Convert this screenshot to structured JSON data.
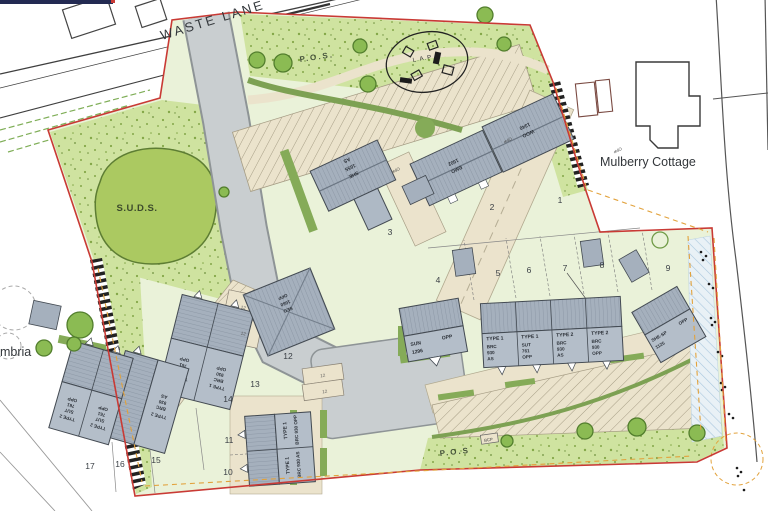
{
  "labels": {
    "waste_lane": "WASTE LANE",
    "mulberry_cottage": "Mulberry Cottage",
    "suds": "S.U.D.S.",
    "pos_top": "P.O.S.",
    "pos_bottom": "P.O.S",
    "lap": "L.A.P",
    "cumbria_partial": "mbria",
    "bcp": "BCP"
  },
  "plot_numbers": [
    "1",
    "2",
    "3",
    "4",
    "5",
    "6",
    "7",
    "8",
    "9",
    "10",
    "11",
    "12",
    "13",
    "14",
    "15",
    "16",
    "17"
  ],
  "bay_labels": [
    "12",
    "12",
    "12",
    "12"
  ],
  "opp_notes": [
    "OPP",
    "OPP",
    "OPP"
  ],
  "houses": {
    "plot1": {
      "name": "WOO",
      "size": "1340"
    },
    "plot2": {
      "name": "BMO",
      "size": "1502"
    },
    "plot3": {
      "name": "SHE",
      "size": "1655",
      "hand": "AS"
    },
    "sun": {
      "name": "SUN",
      "size": "1296",
      "hand": "OPP"
    },
    "terrace": [
      {
        "type": "TYPE 1",
        "l1": "BRC",
        "l2": "930",
        "l3": "AS"
      },
      {
        "type": "TYPE 1",
        "l1": "SUT",
        "l2": "761",
        "l3": "OPP"
      },
      {
        "type": "TYPE 2",
        "l1": "BRC",
        "l2": "930",
        "l3": "AS"
      },
      {
        "type": "TYPE 2",
        "l1": "BRC",
        "l2": "930",
        "l3": "OPP"
      }
    ],
    "shesp": {
      "name": "SHE-SP",
      "size": "1125",
      "hand": "OPP"
    },
    "v11": {
      "type": "TYPE 1",
      "spec": "BRC 930 OPP"
    },
    "v10": {
      "type": "TYPE 1",
      "spec": "BRC 930 AS"
    },
    "w14": {
      "type": "TYPE 2",
      "l1": "SUT",
      "l2": "761",
      "l3": "OPP"
    },
    "w13": {
      "type": "TYPE 1",
      "l1": "BRC",
      "l2": "930",
      "l3": "OPP"
    },
    "p15": {
      "type": "TYPE 2",
      "l1": "BRC",
      "l2": "930",
      "l3": "AS"
    },
    "p16": {
      "type": "TYPE 2",
      "l1": "SUT",
      "l2": "761",
      "l3": "OPP"
    },
    "p17": {
      "type": "TYPE 2",
      "l1": "SUT",
      "l2": "761",
      "l3": "OPP"
    },
    "hip": {
      "name": "SEO",
      "size": "1660",
      "hand": "OPP"
    }
  },
  "colors": {
    "boundary_red": "#c93a35",
    "easement_orange": "#e2a23c",
    "road_grey": "#c9ced0",
    "roof_grey": "#a5b0bd",
    "plot_green": "#eaf2d9",
    "pos_green": "#cfe3a0",
    "suds_green": "#abc961",
    "drive_cream": "#ebe3cc",
    "tree_green": "#8bbb53",
    "hedge_green": "#7da153",
    "titlebar_navy": "#232a52"
  }
}
